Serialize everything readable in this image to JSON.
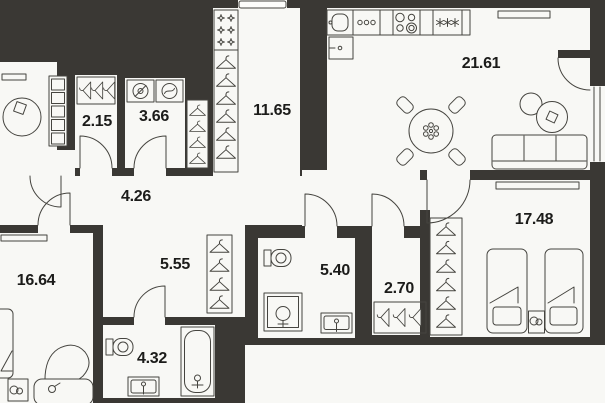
{
  "plan": {
    "type": "apartment-floor-plan",
    "rooms": [
      {
        "id": "kitchen-living-room",
        "area": "21.61"
      },
      {
        "id": "entry-hall",
        "area": "11.65"
      },
      {
        "id": "corridor",
        "area": "4.26"
      },
      {
        "id": "wardrobe-closet",
        "area": "2.15"
      },
      {
        "id": "laundry-room",
        "area": "3.66"
      },
      {
        "id": "inner-hall",
        "area": "5.55"
      },
      {
        "id": "bathroom-1",
        "area": "5.40"
      },
      {
        "id": "closet",
        "area": "2.70"
      },
      {
        "id": "bathroom-2",
        "area": "4.32"
      },
      {
        "id": "bedroom-1",
        "area": "16.64"
      },
      {
        "id": "bedroom-2",
        "area": "17.48"
      }
    ],
    "colors": {
      "wall": "#3a3834",
      "floor": "#f8f8f5",
      "line": "#45443f",
      "label": "#1c1c1a"
    }
  }
}
